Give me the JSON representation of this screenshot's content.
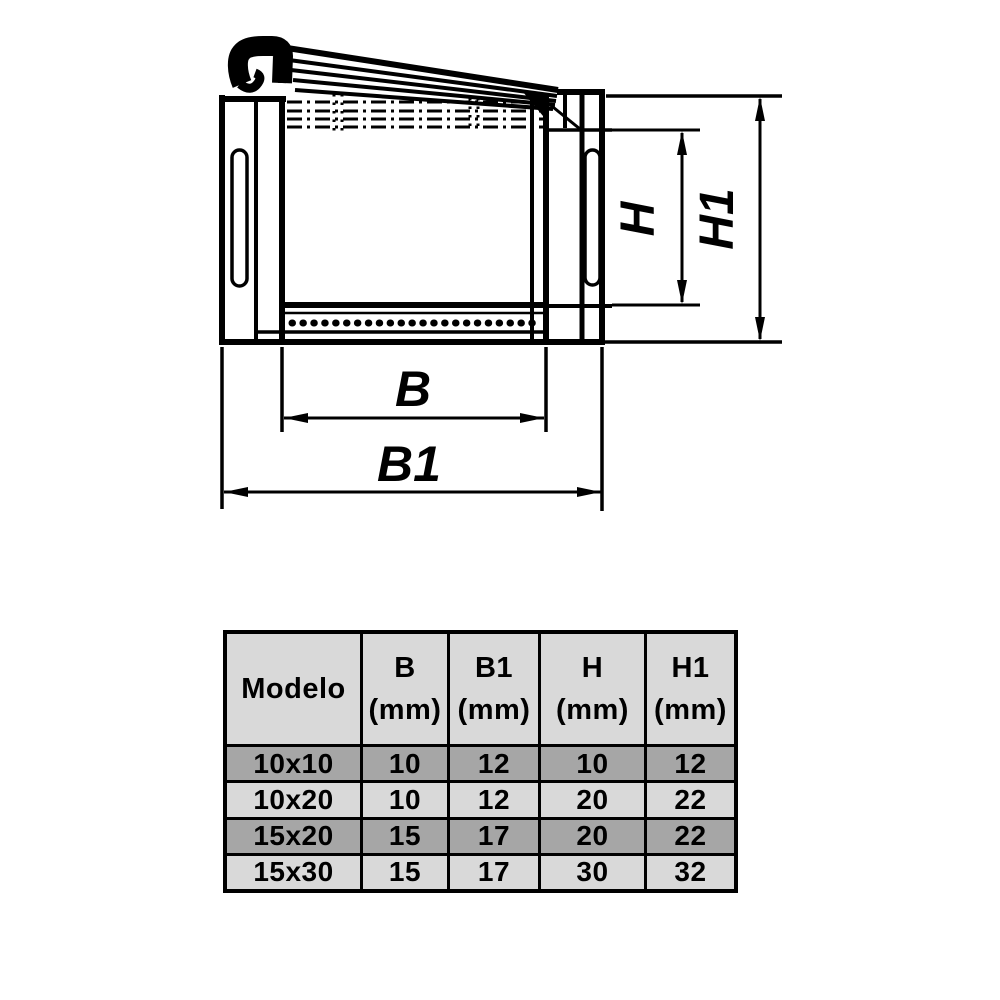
{
  "diagram": {
    "labels": {
      "b": "B",
      "b1": "B1",
      "h": "H",
      "h1": "H1"
    },
    "line_color": "#000000"
  },
  "table": {
    "border_color": "#000000",
    "header_bg": "#d9d9d9",
    "row_dark_bg": "#a6a6a6",
    "row_light_bg": "#d9d9d9",
    "text_color": "#000000",
    "header": [
      {
        "top": "Modelo",
        "bottom": ""
      },
      {
        "top": "B",
        "bottom": "(mm)"
      },
      {
        "top": "B1",
        "bottom": "(mm)"
      },
      {
        "top": "H",
        "bottom": "(mm)"
      },
      {
        "top": "H1",
        "bottom": "(mm)"
      }
    ],
    "rows": [
      {
        "modelo": "10x10",
        "b": "10",
        "b1": "12",
        "h": "10",
        "h1": "12"
      },
      {
        "modelo": "10x20",
        "b": "10",
        "b1": "12",
        "h": "20",
        "h1": "22"
      },
      {
        "modelo": "15x20",
        "b": "15",
        "b1": "17",
        "h": "20",
        "h1": "22"
      },
      {
        "modelo": "15x30",
        "b": "15",
        "b1": "17",
        "h": "30",
        "h1": "32"
      }
    ]
  }
}
